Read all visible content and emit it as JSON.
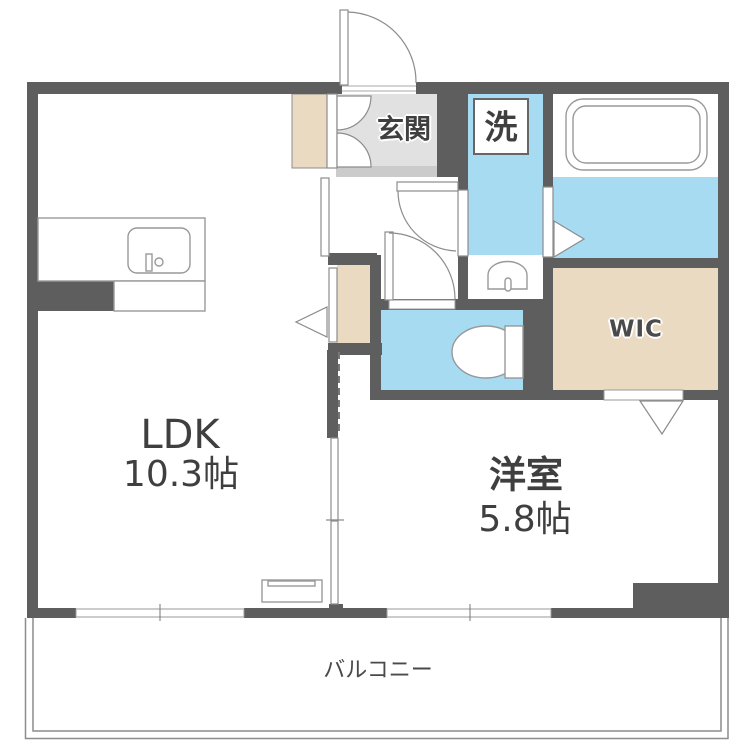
{
  "colors": {
    "wall": "#5E5E5E",
    "water_blue": "#A6DBF2",
    "wood_tan": "#EADAC2",
    "entrance_gray": "#E1E1E1",
    "step_gray": "#CBCBCB",
    "fixture_line": "#8C8C8C",
    "text": "#3F3F3F"
  },
  "rooms": {
    "ldk": {
      "label": "LDK",
      "size": "10.3帖"
    },
    "western_room": {
      "label": "洋室",
      "size": "5.8帖"
    },
    "entrance": {
      "label": "玄関"
    },
    "laundry_space": {
      "label": "洗"
    },
    "wic": {
      "label": "WIC"
    },
    "balcony": {
      "label": "バルコニー"
    }
  },
  "fixtures": {
    "bathtub": "bathtub-icon",
    "kitchen_sink": "kitchen-sink-icon",
    "toilet": "toilet-icon",
    "washbasin": "washbasin-icon",
    "tv_board": "tv-board-icon"
  }
}
